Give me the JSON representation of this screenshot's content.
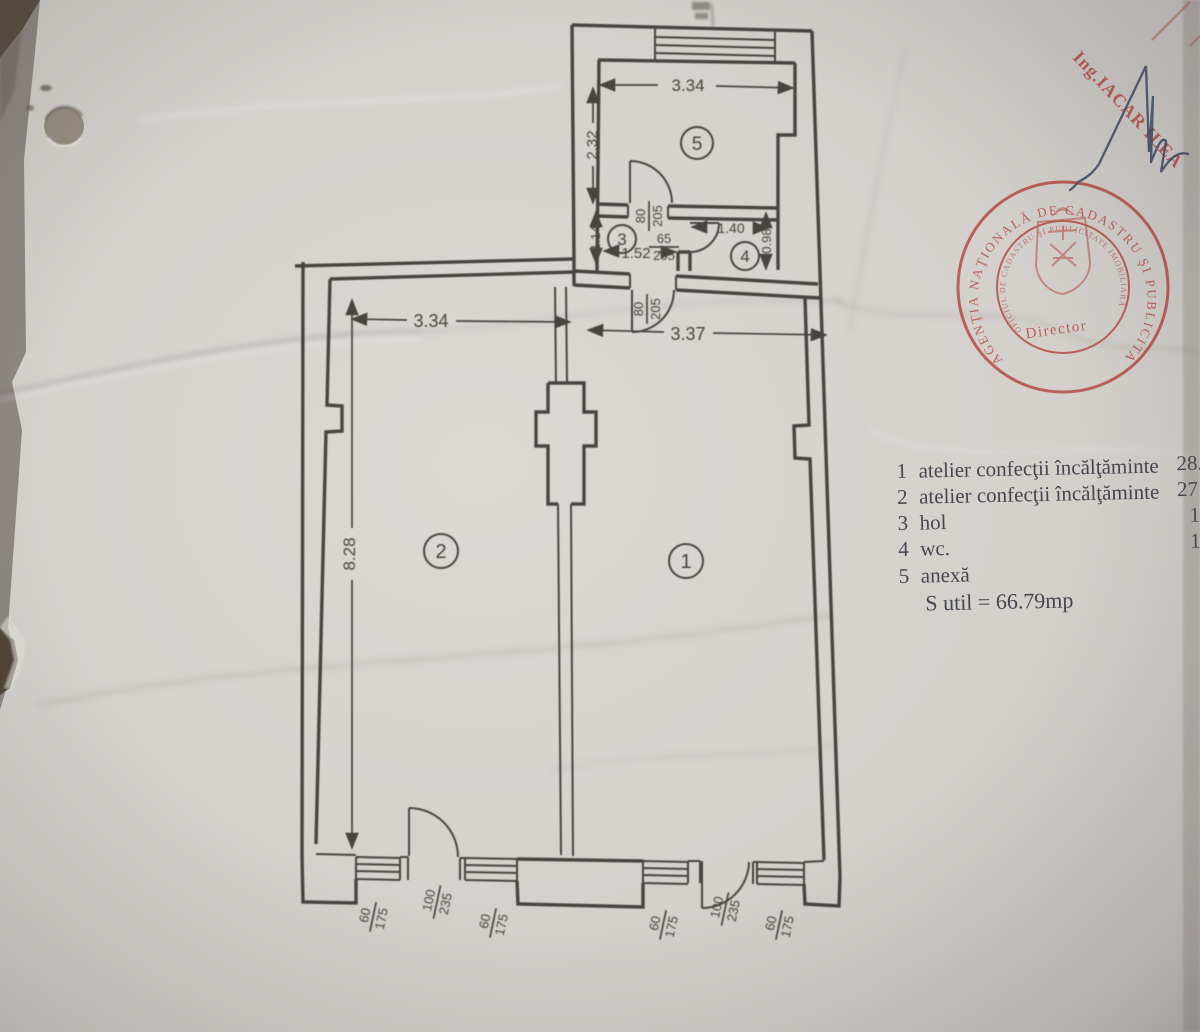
{
  "photo": {
    "paper_color": "#d8d5d1",
    "table_color": "#8e8884",
    "ink_color": "#3a3631",
    "stamp_color": "#b5443b",
    "signature_color": "#44506b"
  },
  "plan": {
    "rooms": [
      {
        "id": "1",
        "label": "1"
      },
      {
        "id": "2",
        "label": "2"
      },
      {
        "id": "3",
        "label": "3"
      },
      {
        "id": "4",
        "label": "4"
      },
      {
        "id": "5",
        "label": "5"
      }
    ],
    "dims": {
      "room5_width": "3.34",
      "room5_height": "2.32",
      "hall_height": "1.14",
      "hall_width": "1.52",
      "wc_width": "1.40",
      "wc_height": "0.98",
      "room2_width": "3.34",
      "room1_width": "3.37",
      "room2_height": "8.28"
    },
    "openings": {
      "door_room5": {
        "w": "80",
        "h": "205"
      },
      "door_wc": {
        "w": "65",
        "h": "205"
      },
      "door_room1": {
        "w": "80",
        "h": "205"
      },
      "door_entry_left": {
        "w": "100",
        "h": "235"
      },
      "door_entry_right": {
        "w": "100",
        "h": "235"
      },
      "window_1": {
        "w": "60",
        "h": "175"
      },
      "window_2": {
        "w": "60",
        "h": "175"
      },
      "window_3": {
        "w": "60",
        "h": "175"
      },
      "window_4": {
        "w": "60",
        "h": "175"
      }
    }
  },
  "legend": {
    "items": [
      {
        "num": "1",
        "name": "atelier confecţii încălţăminte",
        "value": "28."
      },
      {
        "num": "2",
        "name": "atelier confecţii încălţăminte",
        "value": "27"
      },
      {
        "num": "3",
        "name": "hol",
        "value": "1"
      },
      {
        "num": "4",
        "name": "wc.",
        "value": "1"
      },
      {
        "num": "5",
        "name": "anexă",
        "value": ""
      }
    ],
    "total": "S util = 66.79mp"
  },
  "stamp": {
    "ring_text": "AGENŢIA NAŢIONALĂ DE CADASTRU ŞI PUBLICITATE IMOBILIARĂ",
    "inner_text": "OFICIUL DE CADASTRU ŞI PUBLICITATE IMOBILIARĂ",
    "title": "Director"
  },
  "annotations": {
    "engineer_stamp": "Ing.IACAR ILEA"
  }
}
